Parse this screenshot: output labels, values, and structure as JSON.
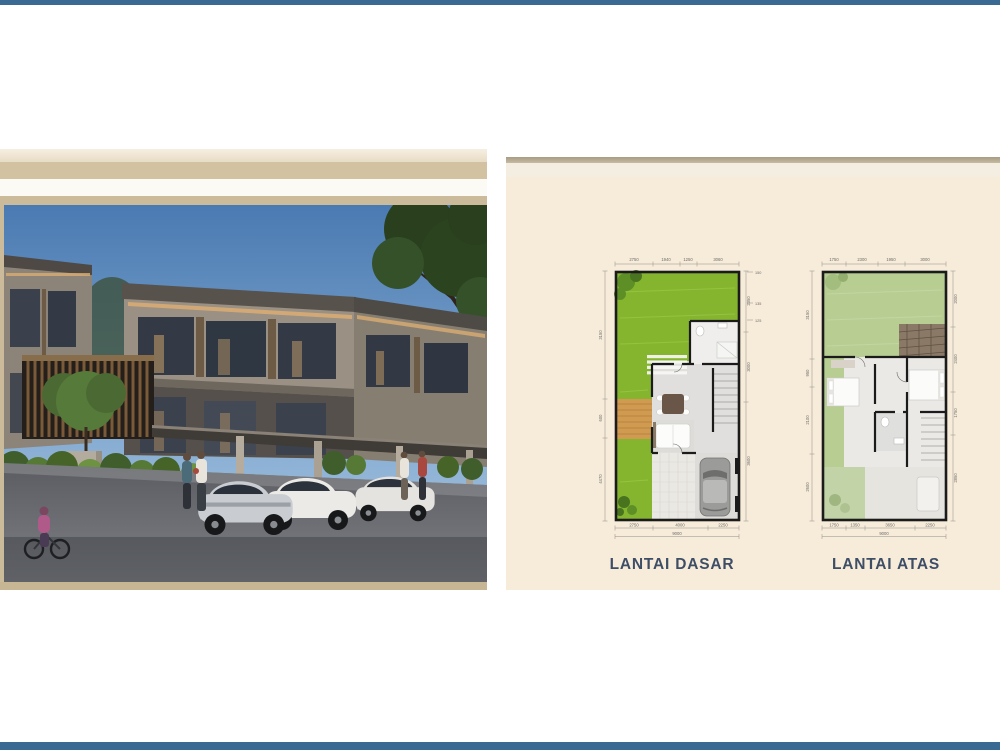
{
  "slide": {
    "background": "#ffffff",
    "top_bar_color": "#3a6a94",
    "bottom_bar_color": "#3a6a94"
  },
  "photo_panel": {
    "frame": {
      "band_outer": "#ebe0cb",
      "band_tan": "#d2c2a2",
      "band_white": "#fbfaf5",
      "band_inner": "#cbbb9b",
      "band_bottom": "#c6b694"
    },
    "scene_colors": {
      "sky_top": "#4a7ab2",
      "sky_bottom": "#b5c8da",
      "facade": "#9a9083",
      "parapet": "#57524c",
      "window_glass": "#333a46",
      "warm_light": "#dcae74",
      "foliage": "#2b431f",
      "road": "#43454a"
    }
  },
  "plans_panel": {
    "background": "#f7ebda",
    "label_color": "#3d4e66",
    "wall_color": "#1b1b1b",
    "ground_floor": {
      "label": "LANTAI DASAR",
      "garden_color": "#85b52f",
      "deck_color": "#d09b50",
      "dims_top": [
        "2750",
        "1940",
        "1250",
        "3060"
      ],
      "dims_bottom": [
        "2750",
        "4000",
        "2250"
      ],
      "dim_total": "9000",
      "dims_left": [
        "3150",
        "600",
        "4470"
      ],
      "dims_right": [
        "2350",
        "3000",
        "3600"
      ],
      "levels": [
        "150",
        "135",
        "125"
      ]
    },
    "upper_floor": {
      "label": "LANTAI ATAS",
      "garden_color": "#b7cd92",
      "dims_top": [
        "1750",
        "2300",
        "1950",
        "3000"
      ],
      "dims_bottom": [
        "1750",
        "1350",
        "3650",
        "2250"
      ],
      "dim_total": "9000",
      "dims_left": [
        "3150",
        "950",
        "2100",
        "2600"
      ],
      "dims_right": [
        "2000",
        "2400",
        "1750",
        "2850"
      ]
    }
  }
}
